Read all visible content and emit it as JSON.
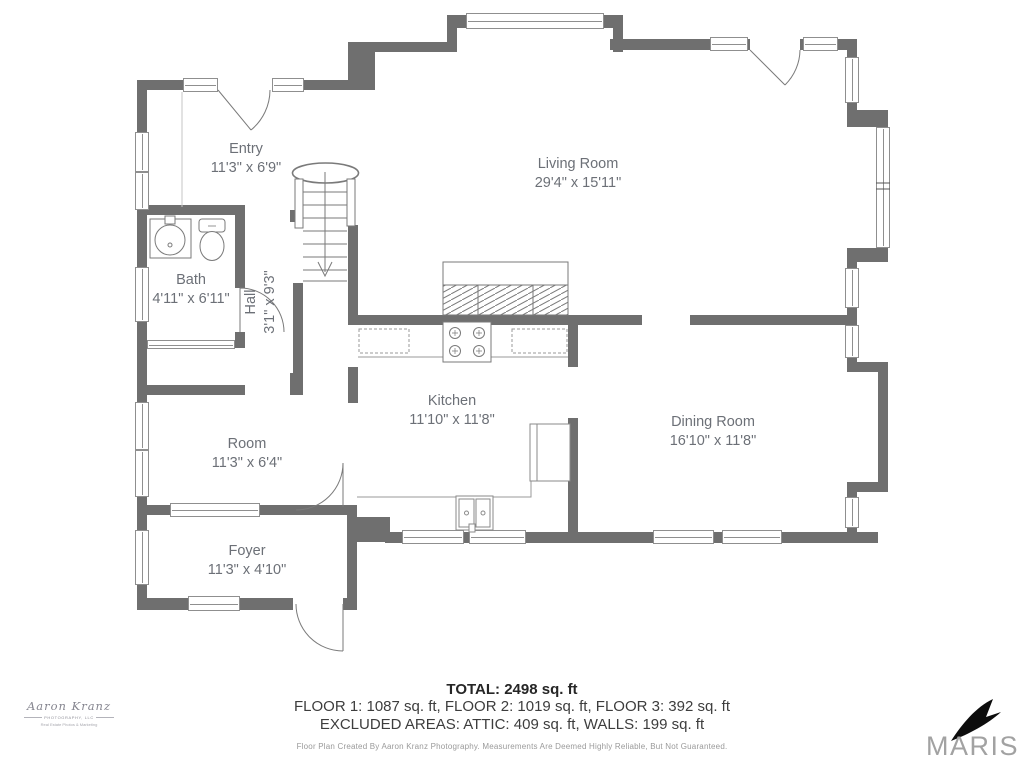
{
  "meta": {
    "wall_color": "#6f6f6f",
    "label_color": "#6c7077",
    "bird_color": "#0d0d0d",
    "maris_text_color": "#a2a2a2"
  },
  "rooms": [
    {
      "id": "entry",
      "name": "Entry",
      "dims": "11'3\" x 6'9\""
    },
    {
      "id": "living",
      "name": "Living Room",
      "dims": "29'4\" x 15'11\""
    },
    {
      "id": "bath",
      "name": "Bath",
      "dims": "4'11\" x 6'11\""
    },
    {
      "id": "hall",
      "name": "Hall",
      "dims": "3'1\" x 9'3\""
    },
    {
      "id": "kitchen",
      "name": "Kitchen",
      "dims": "11'10\" x 11'8\""
    },
    {
      "id": "dining",
      "name": "Dining Room",
      "dims": "16'10\" x 11'8\""
    },
    {
      "id": "room",
      "name": "Room",
      "dims": "11'3\" x 6'4\""
    },
    {
      "id": "foyer",
      "name": "Foyer",
      "dims": "11'3\" x 4'10\""
    }
  ],
  "summary": {
    "total": "TOTAL: 2498 sq. ft",
    "floors": "FLOOR 1: 1087 sq. ft, FLOOR 2: 1019 sq. ft, FLOOR 3: 392 sq. ft",
    "excluded": "EXCLUDED AREAS: ATTIC: 409 sq. ft, WALLS: 199 sq. ft",
    "disclaimer": "Floor Plan Created By Aaron Kranz Photography. Measurements Are Deemed Highly Reliable, But Not Guaranteed."
  },
  "branding": {
    "photographer_script": "Aaron Kranz",
    "photographer_sub": "PHOTOGRAPHY, LLC",
    "photographer_tag": "Real Estate Photos & Marketing",
    "mls_logo": "MARIS"
  }
}
